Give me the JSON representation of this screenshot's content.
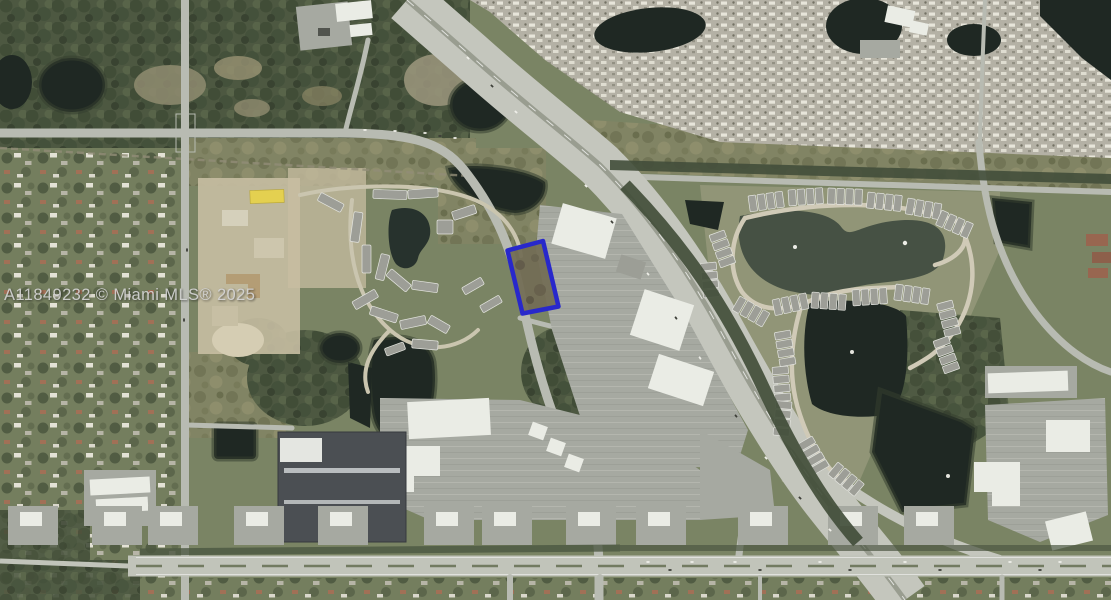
{
  "scene": {
    "type": "satellite-aerial-photo",
    "description": "Aerial MLS listing photo of a suburban commercial corridor: diagonal interstate highway, mobile-home community top right, condo communities with retention ponds, big-box retail, arterial road across the bottom, and a vacant parcel outlined in blue near center."
  },
  "watermark": {
    "text": "A11849232 © Miami MLS® 2025"
  },
  "parcel": {
    "label": "subject-property-boundary",
    "points": "507.5,250.5 543,241 558.5,306.5 522.5,313.5"
  },
  "palette": {
    "vegetation": "#76805f",
    "woodland": "#45513a",
    "scrub": "#7d805f",
    "water": "#141e19",
    "pondMurky": "#3e4a3d",
    "road": "#b9bcb3",
    "highway": "#c5c7bf",
    "arterial": "#c2c5bc",
    "parking": "#a5a8a1",
    "buildingWhite": "#eef0ea",
    "buildingGray": "#9b9d96",
    "buildingDark": "#43474d",
    "dirt": "#c9bfa2",
    "parkBase": "#b4b1a5",
    "parcel": "#1e1ece",
    "watermark": "#d3d3d3"
  }
}
